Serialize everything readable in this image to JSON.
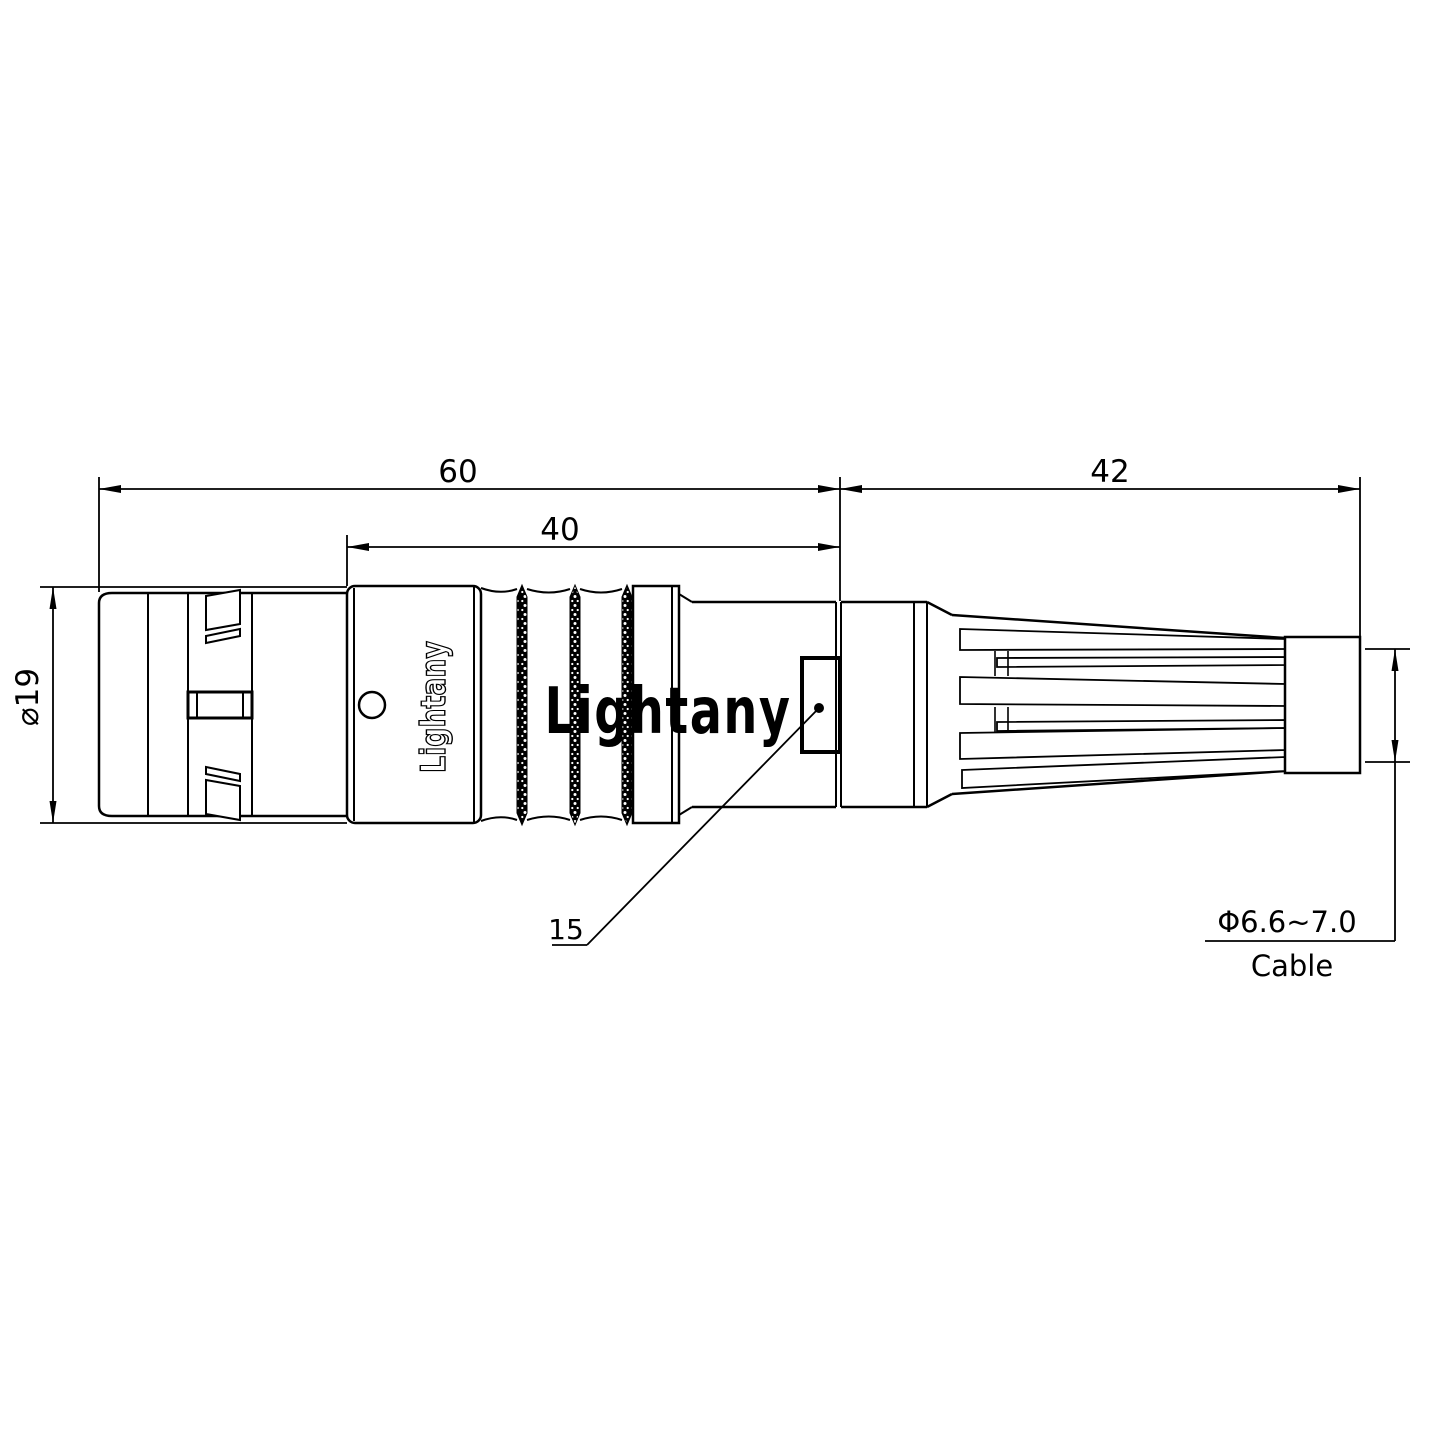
{
  "drawing": {
    "dimensions": {
      "overall_length": "60",
      "front_section_length": "40",
      "boot_length": "42",
      "body_diameter": "⌀19",
      "window_callout": "15",
      "cable_diameter": "Φ6.6~7.0",
      "cable_word": "Cable"
    },
    "branding": {
      "body_text": "Lightany",
      "watermark_text": "Lightany"
    },
    "colors": {
      "line": "#000000",
      "watermark_pink": "#f3b6be",
      "background": "#ffffff"
    }
  }
}
